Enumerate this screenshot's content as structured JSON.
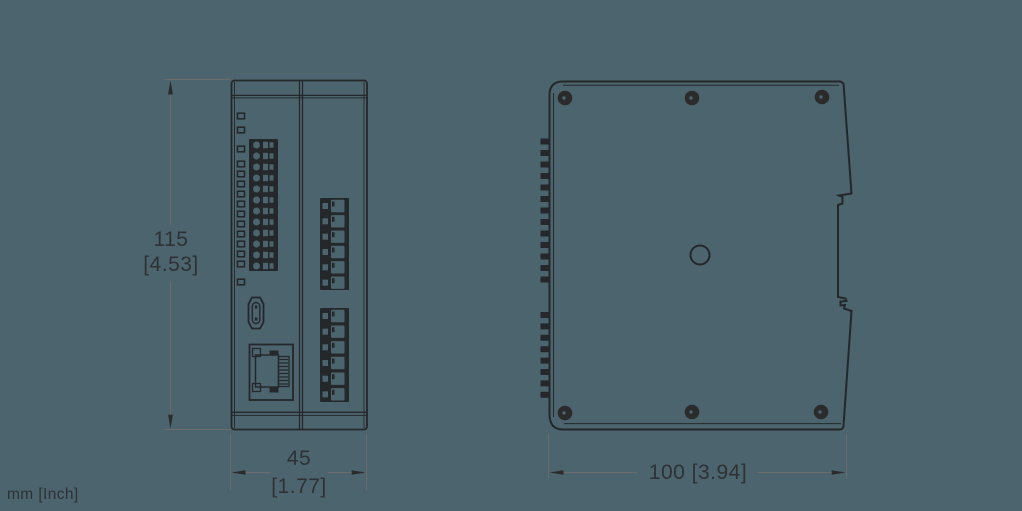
{
  "title": "Device dimension drawing, front and side views",
  "dimensions": {
    "height": {
      "mm": "115",
      "inch": "[4.53]"
    },
    "front_width": {
      "mm": "45",
      "inch": "[1.77]"
    },
    "side_width": {
      "label": "100 [3.94]"
    },
    "units_note": "mm [Inch]"
  },
  "icons": {
    "led": "led-indicator-icon",
    "terminal": "terminal-block-icon",
    "usb": "usb-port-icon",
    "ethernet": "ethernet-port-icon",
    "screw": "screw-icon",
    "hole": "mounting-hole-icon",
    "din_clip": "din-rail-clip-icon"
  },
  "colors": {
    "background": "#4c646e",
    "line": "#24282a",
    "dim_line": "#6b6b6b",
    "arrow": "#2b2b2b",
    "text": "#2e3234"
  }
}
